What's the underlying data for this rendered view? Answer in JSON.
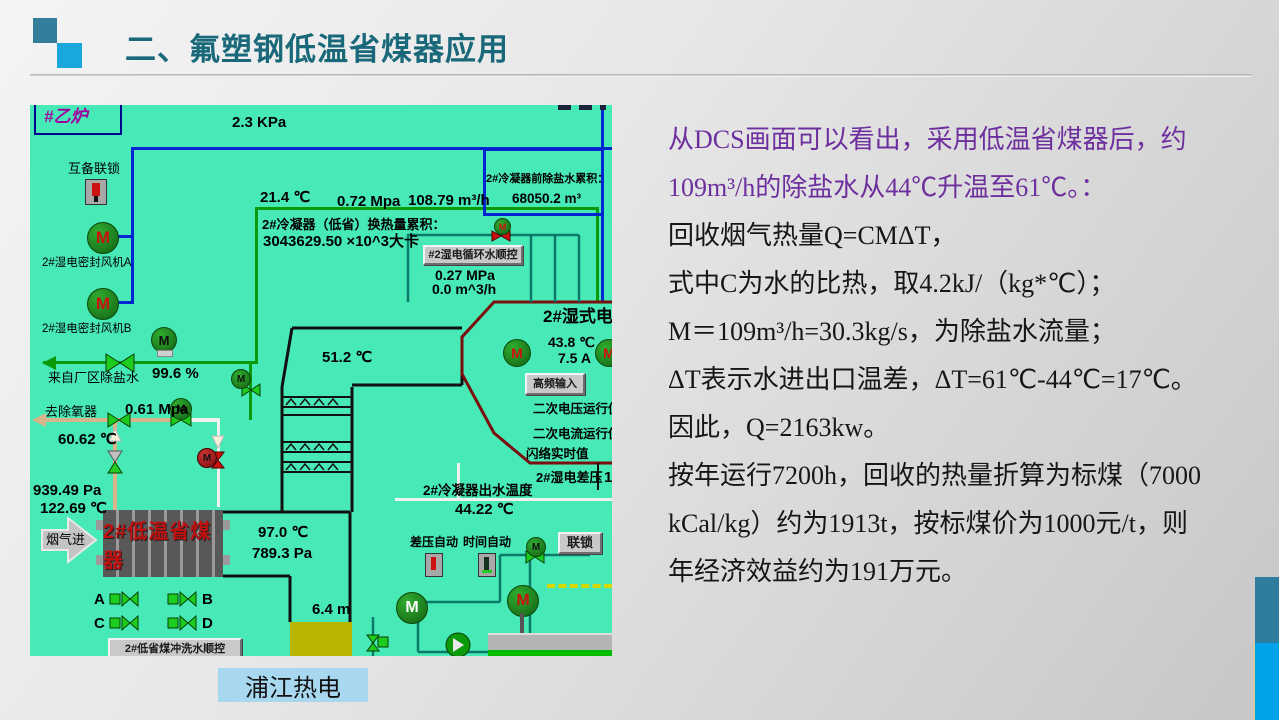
{
  "slide": {
    "title": "二、氟塑钢低温省煤器应用",
    "caption": "浦江热电",
    "colors": {
      "title": "#19697a",
      "accent_purple": "#6e2f9e",
      "dcs_background": "#47e9b6",
      "caption_background": "#a8d8f0",
      "economizer_text": "#c01010",
      "deco_teal": "#2e7d9e",
      "deco_blue": "#00a3e8"
    }
  },
  "content": {
    "lines": [
      "从DCS画面可以看出，采用低温省煤器后，约",
      "109m³/h的除盐水从44℃升温至61℃。：",
      "回收烟气热量Q=CMΔT，",
      "式中C为水的比热，取4.2kJ/（kg*℃）；",
      "M＝109m³/h=30.3kg/s，为除盐水流量；",
      "ΔT表示水进出口温差，ΔT=61℃-44℃=17℃。",
      "因此，Q=2163kw。",
      "按年运行7200h，回收的热量折算为标煤（7000",
      "kCal/kg）约为1913t，按标煤价为1000元/t，则",
      "年经济效益约为191万元。"
    ]
  },
  "dcs": {
    "motor_letter": "M",
    "unit_box": "#乙炉",
    "pressure_top": "2.3 KPa",
    "interlock_label": "互备联锁",
    "fan_a": "2#湿电密封风机A",
    "fan_b": "2#湿电密封风机B",
    "temp_inlet": "21.4 ℃",
    "pressure_water": "0.72 Mpa",
    "flow_water": "108.79 m³/h",
    "accum_label": "2#冷凝器前除盐水累积：",
    "accum_value": "68050.2 m³",
    "heat_label": "2#冷凝器（低省）换热量累积：",
    "heat_value": "3043629.50 ×10^3大卡",
    "seq_button": "#2湿电循环水顺控",
    "circ_pressure": "0.27 MPa",
    "circ_flow": "0.0 m^3/h",
    "temp_mid": "51.2 ℃",
    "from_plant_label": "来自厂区除盐水",
    "valve_open": "99.6 %",
    "to_deaerator_label": "去除氧器",
    "pressure_deaerator": "0.61 Mpa",
    "temp_deaerator": "60.62 ℃",
    "pa_flue_in": "939.49 Pa",
    "temp_flue_in": "122.69 ℃",
    "flue_in_label": "烟气进",
    "economizer_label": "2#低温省煤器",
    "temp_flue_out": "97.0 ℃",
    "pa_flue_out": "789.3 Pa",
    "valve_a": "A",
    "valve_b": "B",
    "valve_c": "C",
    "valve_d": "D",
    "bottom_button": "2#低省煤冲洗水顺控",
    "duct_height": "6.4 m",
    "esp_title": "2#湿式电除",
    "esp_temp": "43.8 ℃",
    "esp_current": "7.5 A",
    "hf_button": "高频输入",
    "sec_voltage": "二次电压运行值",
    "sec_current": "二次电流运行值",
    "flash_label": "闪络实时值",
    "dp_label": "2#湿电差压",
    "dp_value": "1",
    "outlet_label": "2#冷凝器出水温度",
    "outlet_value": "44.22 ℃",
    "dp_auto": "差压自动",
    "time_auto": "时间自动",
    "interlock_button": "联锁"
  }
}
